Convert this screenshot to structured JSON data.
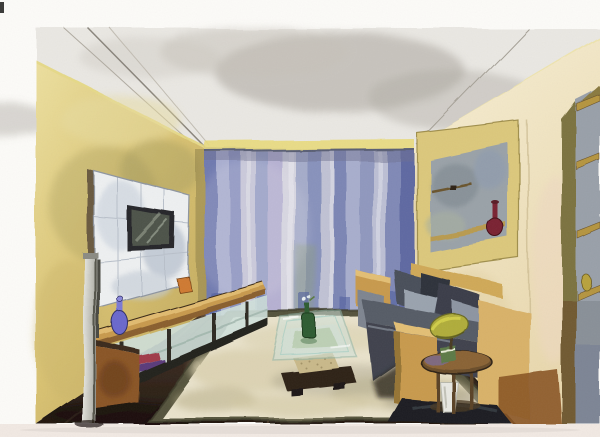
{
  "meta": {
    "kind": "watercolor painting (scanned artwork, no text)",
    "subject": "living room interior drawn in one-point perspective",
    "orientation": "landscape on white paper with margins"
  },
  "scene": {
    "room": [
      "gray-wash ceiling with recessed cove lighting strip",
      "ochre-yellow left wall",
      "pale cream right wall",
      "dark brown wood plank floor",
      "blue-violet striped floor-to-ceiling curtain on far wall",
      "cream area rug with dark olive border"
    ],
    "furniture": [
      "white tiled media panel with wall-mounted tv",
      "long light-wood media console with glass shelves",
      "brown cabinet at near end of console",
      "metal floor pole in left foreground",
      "charcoal sofa with light wood frame and gray pillows",
      "round wooden side table with green-yellow shaded lamp",
      "dark platform under side table",
      "glass-top coffee table on dark wood base",
      "recessed display niche with rails and shelf on right wall",
      "tall shelf niche at far right edge"
    ],
    "objects": [
      "blue long-neck vase on console",
      "orange box on console",
      "red and violet books on console shelf",
      "green bottle with white flower on coffee table",
      "white vase with green plant under side table",
      "maroon long-neck vase in wall niche",
      "small yellow pear ornament on right shelf"
    ]
  },
  "palette": {
    "paper": "#fcfbf8",
    "paper_edge": "#f1e9e3",
    "ceiling": "#eae8e3",
    "ceiling_shadow": "#b2ada6",
    "cove_glow": "#e6d77e",
    "wall_left": "#d9c272",
    "wall_left_deep": "#c0a85c",
    "wall_right": "#f2e7c7",
    "wall_right_shade": "#e4d1a4",
    "curtain_base": "#9aa2c8",
    "curtain_indigo": "#707ab0",
    "curtain_light": "#d6d5e0",
    "curtain_deep": "#4d5c9e",
    "floor": "#3c2d21",
    "floor_dark": "#221810",
    "rug": "#eae3cc",
    "rug_border": "#55533c",
    "rug_blotch": "#d5caa6",
    "wood": "#c89a4e",
    "wood_light": "#e3bf74",
    "wood_dark": "#8a5f2e",
    "cabinet_brown": "#8a5526",
    "sofa": "#3f434d",
    "sofa_light": "#9aa3ae",
    "sofa_dark": "#2e323b",
    "panel": "#eef0f1",
    "tv_frame": "#26262a",
    "tv_screen": "#4d5349",
    "glass": "#cfe2dc",
    "glass_edge": "#8fb5aa",
    "bottle_green": "#2e5c30",
    "vase_blue": "#6a68cc",
    "vase_maroon": "#7a2230",
    "lamp_shade": "#b0ad3a",
    "niche_gray": "#9aa2a8",
    "plant_green": "#5d7a3e",
    "vase_white": "#e8e8e2",
    "platform_dark": "#1c1e22"
  }
}
